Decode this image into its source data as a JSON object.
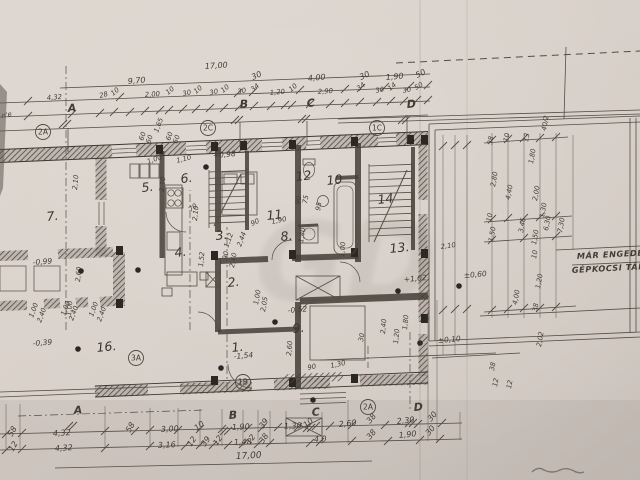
{
  "meta": {
    "kind": "scanned hand-drawn floor plan",
    "language": "Hungarian"
  },
  "notes": {
    "line1": "MÁR ENGEDÉ",
    "line2": "GÉPKOCSI TÁRO",
    "edge_note": "n'e"
  },
  "colors": {
    "paper": "#d8d0c9",
    "ink": "#4e4840",
    "wall": "#3c3731",
    "shadow": "#5e564d"
  },
  "dims": {
    "top_row0": [
      [
        "17,00",
        205,
        69,
        -4
      ]
    ],
    "top_row1": [
      [
        "9,70",
        128,
        84,
        -5
      ],
      [
        "30",
        253,
        80,
        -25
      ],
      [
        "4,00",
        308,
        81,
        -5
      ],
      [
        "30",
        361,
        80,
        -25
      ],
      [
        "1,90",
        386,
        80,
        -5
      ],
      [
        "50",
        417,
        78,
        -25
      ]
    ],
    "top_row2": [
      [
        "4,32",
        47,
        100,
        -4
      ],
      [
        "28",
        100,
        98,
        -15
      ],
      [
        "10",
        113,
        96,
        -40
      ],
      [
        "2,00",
        145,
        97,
        -4
      ],
      [
        "10",
        168,
        95,
        -40
      ],
      [
        "30",
        183,
        96,
        -12
      ],
      [
        "10",
        196,
        94,
        -40
      ],
      [
        "30",
        210,
        95,
        -12
      ],
      [
        "10",
        223,
        93,
        -40
      ],
      [
        "30",
        238,
        94,
        -12
      ],
      [
        "34",
        253,
        92,
        -40
      ],
      [
        "1,20",
        270,
        95,
        -5
      ],
      [
        "10",
        291,
        92,
        -40
      ],
      [
        "2,90",
        318,
        94,
        -4
      ],
      [
        "34",
        359,
        91,
        -40
      ],
      [
        "30",
        376,
        93,
        -12
      ],
      [
        "14",
        390,
        91,
        -40
      ],
      [
        "30",
        403,
        93,
        -12
      ],
      [
        "50",
        416,
        90,
        -30
      ]
    ],
    "bottom_row1": [
      [
        "58",
        12,
        437,
        -60
      ],
      [
        "4,32",
        53,
        436,
        -3
      ],
      [
        "58",
        130,
        433,
        -60
      ],
      [
        "3,00",
        161,
        432,
        -3
      ],
      [
        "10",
        197,
        431,
        -40
      ],
      [
        "1,90",
        232,
        430,
        -3
      ],
      [
        "39",
        263,
        429,
        -55
      ],
      [
        "1,30",
        284,
        429,
        -3
      ],
      [
        "10",
        306,
        428,
        -40
      ]
    ],
    "bottom_row2": [
      [
        "12",
        13,
        452,
        -60
      ],
      [
        "4,32",
        55,
        451,
        -3
      ],
      [
        "3,16",
        158,
        448,
        -3
      ],
      [
        "12",
        191,
        447,
        -55
      ],
      [
        "39",
        205,
        447,
        -55
      ],
      [
        "12",
        217,
        446,
        -55
      ],
      [
        "1,48",
        234,
        445,
        -3
      ],
      [
        "12",
        250,
        445,
        -55
      ],
      [
        "38",
        263,
        444,
        -55
      ],
      [
        "4,0",
        314,
        442,
        -3
      ]
    ],
    "bottom_row3": [
      [
        "17,00",
        236,
        459,
        -3
      ]
    ],
    "bottom_right1": [
      [
        "2,60",
        339,
        427,
        -6
      ],
      [
        "38",
        370,
        424,
        -50
      ],
      [
        "2,30",
        397,
        424,
        -6
      ],
      [
        "30",
        431,
        422,
        -50
      ]
    ],
    "bottom_right2": [
      [
        "38",
        370,
        440,
        -50
      ],
      [
        "1,90",
        399,
        438,
        -6
      ],
      [
        "30",
        429,
        436,
        -50
      ]
    ],
    "garage": [
      [
        "38",
        492,
        145
      ],
      [
        "10",
        508,
        142
      ],
      [
        "13",
        528,
        142
      ],
      [
        "40/2",
        546,
        131
      ],
      [
        "1,80",
        533,
        164
      ],
      [
        "2,80",
        495,
        187
      ],
      [
        "4,40",
        510,
        200
      ],
      [
        "2,00",
        537,
        201
      ],
      [
        "10",
        491,
        222
      ],
      [
        "3,46",
        523,
        233
      ],
      [
        "1,50",
        493,
        242
      ],
      [
        "1,30",
        544,
        218
      ],
      [
        "6,30",
        548,
        231
      ],
      [
        "7,30",
        562,
        233
      ],
      [
        "1,50",
        536,
        245
      ],
      [
        "10",
        536,
        259
      ],
      [
        "1,20",
        540,
        289
      ],
      [
        "4,00",
        517,
        305
      ],
      [
        "38",
        537,
        312
      ],
      [
        "2,02",
        541,
        347
      ],
      [
        "38",
        494,
        371
      ],
      [
        "12",
        497,
        387
      ],
      [
        "12",
        511,
        389
      ],
      [
        "2,10",
        441,
        249,
        -8
      ]
    ],
    "interior": [
      [
        "60",
        143,
        141,
        -70
      ],
      [
        "60",
        150,
        144,
        -70
      ],
      [
        "1,65",
        158,
        133,
        -70
      ],
      [
        "60",
        170,
        141,
        -70
      ],
      [
        "60",
        177,
        144,
        -70
      ],
      [
        "1,00",
        148,
        164,
        -20
      ],
      [
        "1,10",
        177,
        163,
        -15
      ],
      [
        "2,10",
        77,
        190,
        -85
      ],
      [
        "2,60",
        80,
        282,
        -85
      ],
      [
        "1,00",
        71,
        316,
        -85
      ],
      [
        "1,00",
        33,
        318,
        -70
      ],
      [
        "2,40",
        41,
        323,
        -70
      ],
      [
        "1,00",
        65,
        316,
        -70
      ],
      [
        "2,40",
        73,
        321,
        -70
      ],
      [
        "1,00",
        93,
        317,
        -70
      ],
      [
        "2,40",
        101,
        322,
        -70
      ],
      [
        "2,10",
        164,
        192,
        -85
      ],
      [
        "70",
        191,
        212,
        -40
      ],
      [
        "2,10",
        197,
        221,
        -85
      ],
      [
        "1,12",
        228,
        248,
        -70
      ],
      [
        "2,44",
        241,
        247,
        -70
      ],
      [
        "90",
        252,
        226,
        -25
      ],
      [
        "1,90",
        272,
        224,
        -12
      ],
      [
        "95",
        320,
        211,
        -80
      ],
      [
        "90",
        300,
        205,
        -80
      ],
      [
        "1,00",
        344,
        257,
        -85
      ],
      [
        "75",
        307,
        204,
        -80
      ],
      [
        "1,40",
        303,
        243,
        -80
      ],
      [
        "90",
        227,
        260,
        -80
      ],
      [
        "2,40",
        234,
        268,
        -80
      ],
      [
        "1,52",
        203,
        267,
        -85
      ],
      [
        "2,60",
        291,
        356,
        -85
      ],
      [
        "90",
        308,
        370,
        -12
      ],
      [
        "1,30",
        331,
        368,
        -12
      ],
      [
        "2,40",
        385,
        334,
        -85
      ],
      [
        "1,20",
        398,
        344,
        -85
      ],
      [
        "1,80",
        407,
        330,
        -85
      ],
      [
        "30",
        363,
        342,
        -80
      ],
      [
        "1,00",
        258,
        305,
        -80
      ],
      [
        "2,05",
        265,
        312,
        -80
      ]
    ]
  },
  "rooms": [
    [
      "7.",
      47,
      221
    ],
    [
      "5.",
      142,
      192
    ],
    [
      "6.",
      181,
      183
    ],
    [
      "4.",
      175,
      257
    ],
    [
      "3.",
      216,
      240
    ],
    [
      "2.",
      228,
      287
    ],
    [
      "1.",
      232,
      352
    ],
    [
      "8.",
      281,
      241
    ],
    [
      "9.",
      293,
      333
    ],
    [
      "10",
      327,
      185
    ],
    [
      "11",
      267,
      220
    ],
    [
      "12",
      296,
      181
    ],
    [
      "13.",
      390,
      253
    ],
    [
      "14",
      378,
      204
    ],
    [
      "16.",
      97,
      352
    ]
  ],
  "levels": [
    [
      "+0,98",
      213,
      158,
      206,
      167
    ],
    [
      "-0,99",
      33,
      265,
      81,
      271
    ],
    [
      "-0,39",
      33,
      346,
      78,
      349
    ],
    [
      "-0,52",
      288,
      313,
      275,
      322
    ],
    [
      "+1,02",
      404,
      282,
      398,
      291
    ],
    [
      "±0,60",
      464,
      278,
      459,
      286
    ],
    [
      "±0,10",
      438,
      343,
      420,
      343
    ],
    [
      "-1,54",
      234,
      359,
      221,
      368
    ],
    [
      "",
      0,
      0,
      138,
      270
    ],
    [
      "",
      0,
      0,
      313,
      400
    ]
  ],
  "grid_bubbles": [
    [
      "2A",
      43,
      132
    ],
    [
      "2C",
      208,
      128
    ],
    [
      "1C",
      377,
      128
    ],
    [
      "3A",
      136,
      358
    ],
    [
      "1B",
      243,
      382
    ],
    [
      "2A",
      368,
      407
    ]
  ],
  "sections": {
    "top": [
      [
        "A",
        68,
        112
      ],
      [
        "B",
        240,
        108
      ],
      [
        "C",
        307,
        107
      ],
      [
        "D",
        407,
        108
      ]
    ],
    "bottom": [
      [
        "A",
        74,
        414
      ],
      [
        "B",
        229,
        419
      ],
      [
        "C",
        312,
        416
      ],
      [
        "D",
        414,
        411
      ]
    ]
  }
}
